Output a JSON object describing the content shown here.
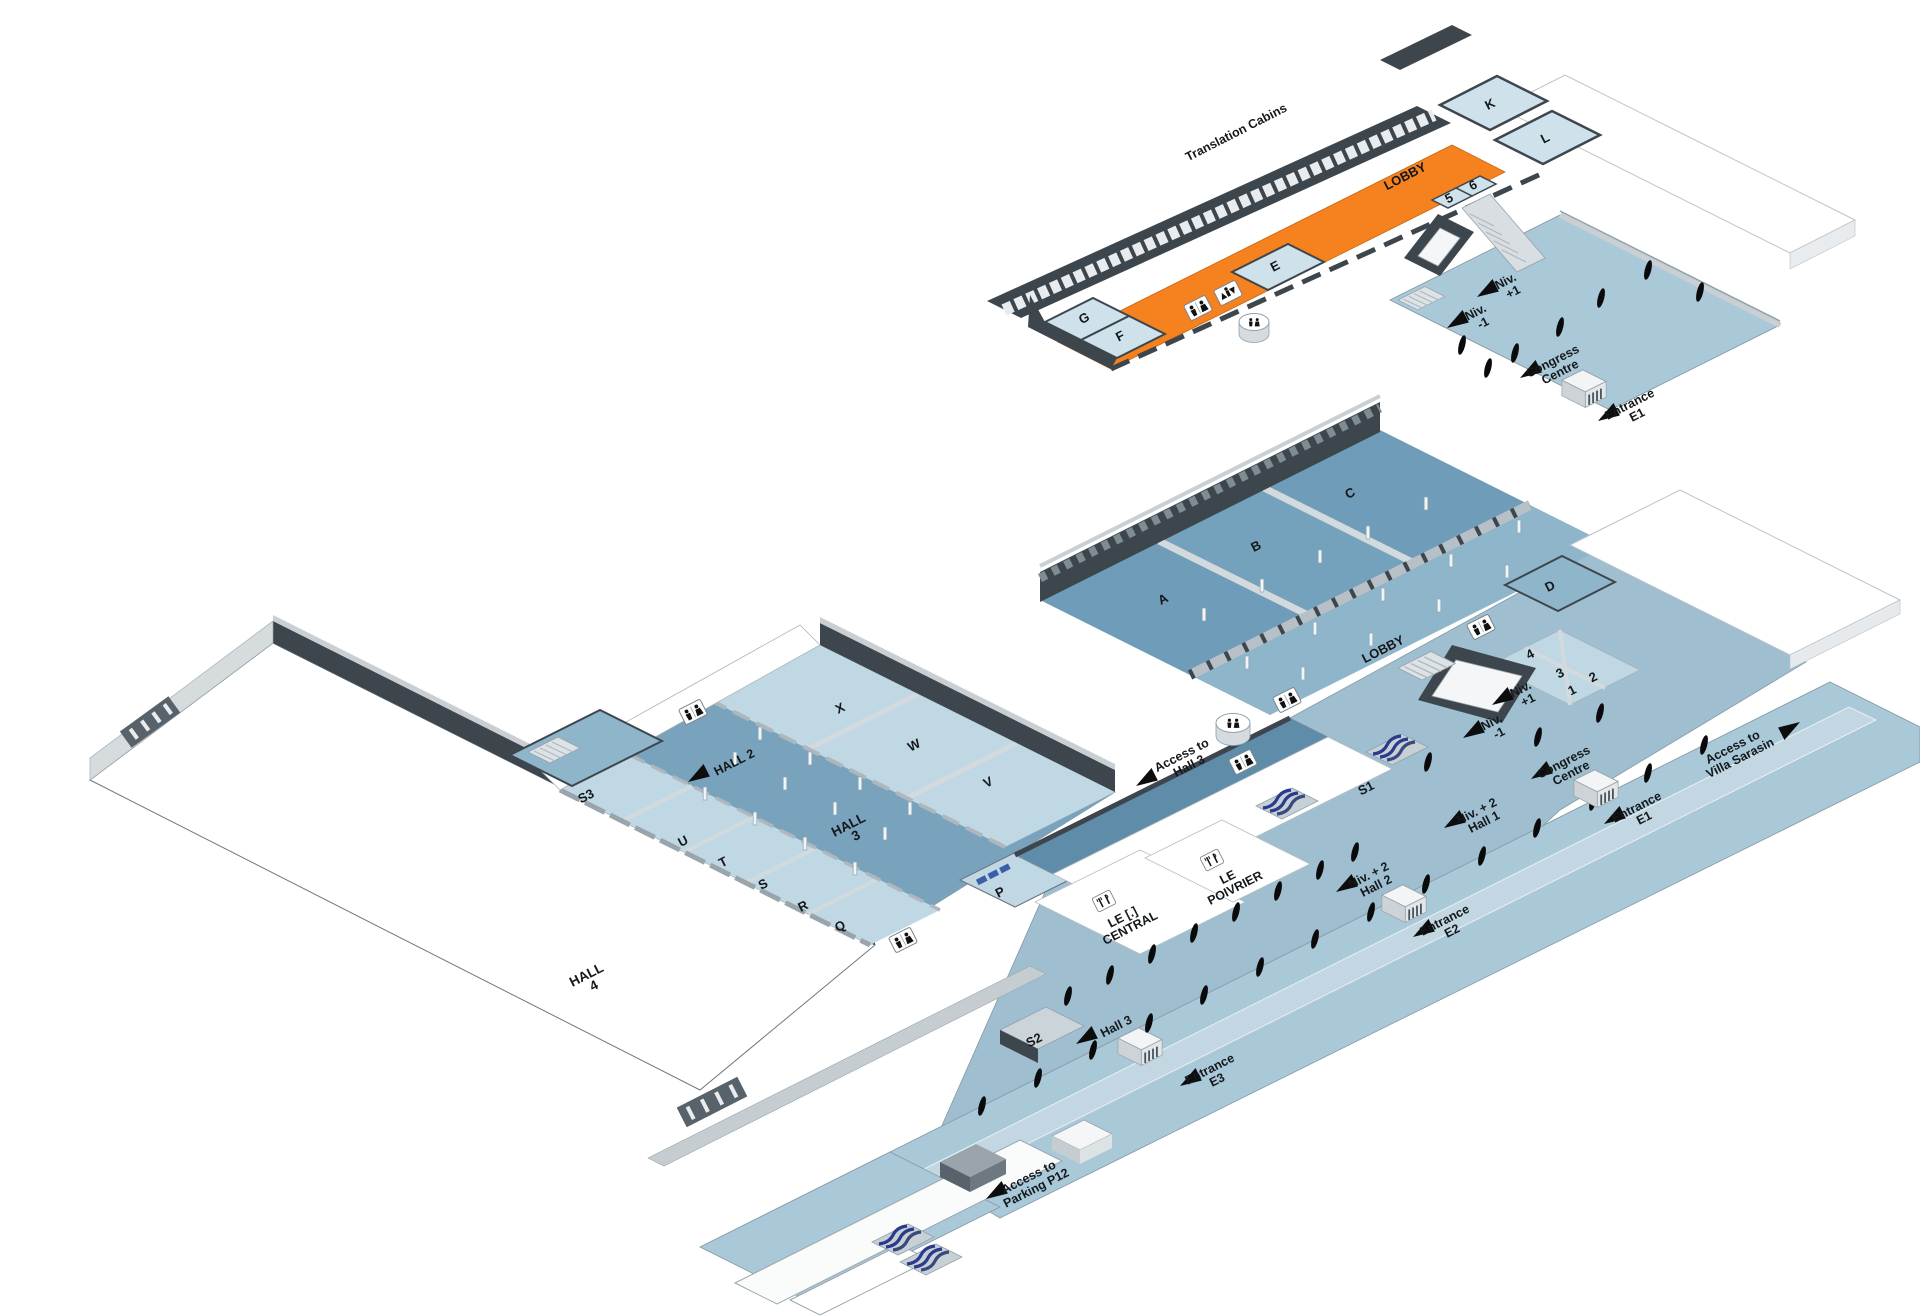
{
  "upper_level": {
    "translation_cabins": "Translation Cabins",
    "lobby": "LOBBY",
    "rooms": {
      "g": "G",
      "f": "F",
      "e": "E",
      "k": "K",
      "l": "L",
      "r5": "5",
      "r6": "6"
    },
    "stair_up": {
      "l1": "Niv.",
      "l2": "+1"
    },
    "stair_down": {
      "l1": "Niv.",
      "l2": "-1"
    },
    "congress_centre": {
      "l1": "Congress",
      "l2": "Centre"
    },
    "entrance_e1": {
      "l1": "Entrance",
      "l2": "E1"
    }
  },
  "ground_level": {
    "lobby": "LOBBY",
    "halls": {
      "a": "A",
      "b": "B",
      "c": "C",
      "d": "D"
    },
    "meeting_rooms": {
      "r1": "1",
      "r2": "2",
      "r3": "3",
      "r4": "4"
    },
    "west_rooms": {
      "x": "X",
      "w": "W",
      "v": "V",
      "u": "U",
      "t": "T",
      "s": "S",
      "r": "R",
      "q": "Q",
      "p": "P"
    },
    "halls_labels": {
      "hall2": "HALL 2",
      "hall3_l1": "HALL",
      "hall3_l2": "3",
      "hall4_l1": "HALL",
      "hall4_l2": "4"
    },
    "escalators": {
      "s1": "S1",
      "s2": "S2",
      "s3": "S3"
    },
    "restaurants": {
      "central": {
        "l1": "LE [.]",
        "l2": "CENTRAL"
      },
      "poivrier": {
        "l1": "LE",
        "l2": "POIVRIER"
      }
    },
    "directions": {
      "access_hall3": {
        "l1": "Access to",
        "l2": "Hall 3"
      },
      "hall3": {
        "l1": "Hall 3"
      },
      "access_villa": {
        "l1": "Access to",
        "l2": "Villa Sarasin"
      },
      "access_parking": {
        "l1": "Access to",
        "l2": "Parking P12"
      },
      "niv2_hall1": {
        "l1": "Niv. + 2",
        "l2": "Hall 1"
      },
      "niv2_hall2": {
        "l1": "Niv. + 2",
        "l2": "Hall 2"
      },
      "stair_up": {
        "l1": "Niv.",
        "l2": "+1"
      },
      "stair_down": {
        "l1": "Niv.",
        "l2": "-1"
      },
      "congress_centre": {
        "l1": "Congress",
        "l2": "Centre"
      },
      "entrance_e1": {
        "l1": "Entrance",
        "l2": "E1"
      },
      "entrance_e2": {
        "l1": "Entrance",
        "l2": "E2"
      },
      "entrance_e3": {
        "l1": "Entrance",
        "l2": "E3"
      }
    }
  },
  "icons": {
    "toilets": "toilets-icon",
    "lift": "elevator-icon",
    "restaurant": "fork-knife-icon",
    "entrance_door": "revolving-door-icon",
    "escalator": "escalator-icon",
    "direction_arrow": "arrow-icon",
    "bollard": "bollard-marker",
    "pillar": "column-marker"
  },
  "colors": {
    "accent_orange": "#F6821F",
    "hall_floor": "#6F9CB8",
    "lobby_floor": "#8FB5CA",
    "esplanade": "#A9C8D8",
    "room_floor": "#C6DCE8",
    "walkway_dark": "#5E8CA9",
    "wall_dark": "#3E464D",
    "wall_light": "#C9CFD3",
    "escalator_blue": "#2B3B8C"
  }
}
